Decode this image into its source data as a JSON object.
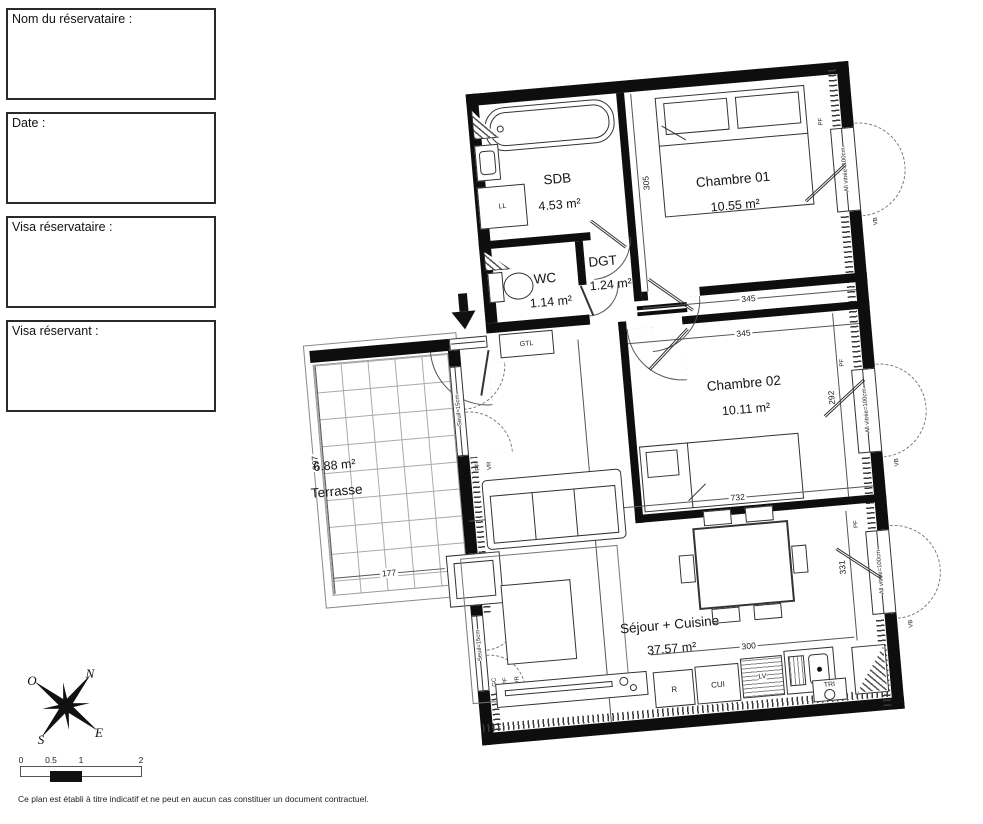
{
  "form_boxes": [
    {
      "label": "Nom du réservataire :"
    },
    {
      "label": "Date :"
    },
    {
      "label": "Visa réservataire :"
    },
    {
      "label": "Visa réservant :"
    }
  ],
  "rooms": {
    "sdb": {
      "name": "SDB",
      "area": "4.53 m²"
    },
    "chambre01": {
      "name": "Chambre 01",
      "area": "10.55 m²"
    },
    "dgt": {
      "name": "DGT",
      "area": "1.24 m²"
    },
    "wc": {
      "name": "WC",
      "area": "1.14 m²"
    },
    "chambre02": {
      "name": "Chambre 02",
      "area": "10.11 m²"
    },
    "terrasse": {
      "name": "Terrasse",
      "area": "6.88 m²"
    },
    "sejour": {
      "name": "Séjour + Cuisine",
      "area": "37.57 m²"
    }
  },
  "dims": {
    "ch01_h": "305",
    "ch01_w": "345",
    "ch02_w": "345",
    "ch02_h": "292",
    "sejour_w": "732",
    "sejour_h": "550",
    "sejour_right_h": "331",
    "kitchen_w": "300",
    "terrasse_h": "397",
    "terrasse_w": "177"
  },
  "windows": {
    "label": "All vitrée=100cm",
    "vb": "VB",
    "pf": "PF"
  },
  "doors": {
    "seuil": "Seuil=15cm",
    "pf": "PF",
    "vr": "VR",
    "gc": "GC"
  },
  "equipment": {
    "ll": "LL",
    "gtl": "GTL",
    "r": "R",
    "cui": "CUI",
    "lv": "LV",
    "tri": "TRI"
  },
  "compass": {
    "n": "N",
    "e": "E",
    "s": "S",
    "o": "O"
  },
  "scalebar": {
    "ticks": [
      "0",
      "0.5",
      "1",
      "2"
    ]
  },
  "footer": {
    "note": "Ce plan est établi à titre indicatif et ne peut en aucun cas constituer un document contractuel."
  }
}
